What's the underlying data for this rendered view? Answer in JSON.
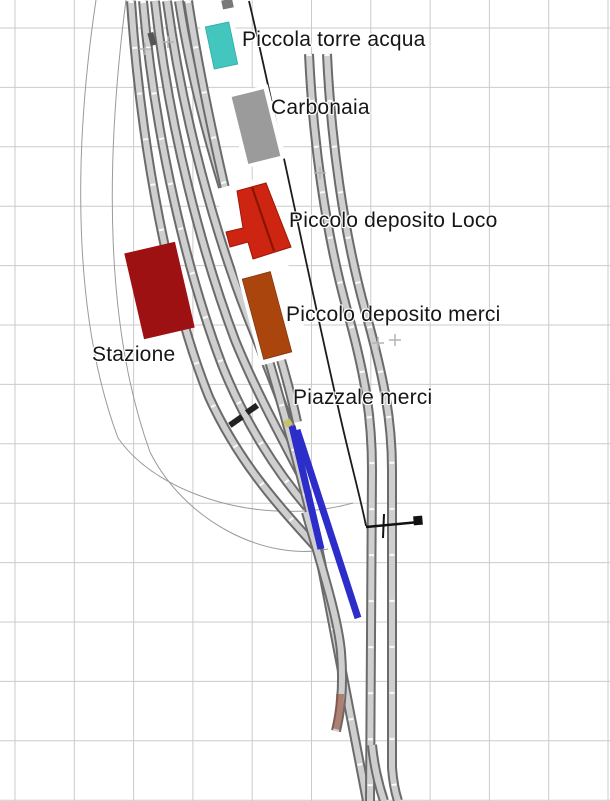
{
  "canvas": {
    "width": 610,
    "height": 801,
    "background": "#ffffff"
  },
  "labels": [
    {
      "id": "torre-acqua",
      "text": "Piccola torre acqua",
      "x": 242,
      "y": 29
    },
    {
      "id": "carbonaia",
      "text": "Carbonaia",
      "x": 271,
      "y": 97
    },
    {
      "id": "deposito-loco",
      "text": "Piccolo deposito Loco",
      "x": 289,
      "y": 210
    },
    {
      "id": "deposito-merci",
      "text": "Piccolo deposito merci",
      "x": 286,
      "y": 304
    },
    {
      "id": "stazione",
      "text": "Stazione",
      "x": 92,
      "y": 344
    },
    {
      "id": "piazzale-merci",
      "text": "Piazzale merci",
      "x": 293,
      "y": 387
    }
  ],
  "colors": {
    "grid": "#cbcbcb",
    "rail_edge": "#6b6b6b",
    "rail_fill": "#cfcfcf",
    "guide_curve": "#9a9a9a",
    "boundary_line": "#1c1c1c",
    "selection_blue": "#2d2dc9",
    "water_tower": "#43c6be",
    "coal_stage": "#9b9b9b",
    "loco_depot": "#ce2412",
    "goods_depot": "#ab450e",
    "station": "#9d1112",
    "marker_plus": "#b3b3b3"
  },
  "trackplan": {
    "grid": {
      "offset_x": 15,
      "offset_y": 28,
      "spacing_x": 59.3,
      "spacing_y": 59.4,
      "color": "#cbcbcb"
    },
    "items": [
      {
        "type": "path",
        "name": "guide-curve-left-outer",
        "click": false,
        "d": "M96,0 C72,160 74,320 118,438 C160,498 268,527 353,503",
        "color": "#9a9a9a",
        "w": 1
      },
      {
        "type": "path",
        "name": "guide-curve-left-inner",
        "click": false,
        "d": "M126,0 C104,170 106,330 150,452 C185,522 266,562 328,549",
        "color": "#9a9a9a",
        "w": 1
      },
      {
        "type": "track",
        "name": "yard-track-5",
        "click": true,
        "ties": false,
        "d": "M179,1 C196,110 230,215 258,290 C272,327 288,380 297,422"
      },
      {
        "type": "track",
        "name": "yard-track-4",
        "click": true,
        "ties": false,
        "d": "M167,1 C183,120 216,235 247,315 C263,355 284,407 299,452"
      },
      {
        "type": "track",
        "name": "yard-track-3",
        "click": true,
        "ties": false,
        "d": "M155,1 C169,130 203,255 235,340 C254,387 281,437 302,477"
      },
      {
        "type": "track",
        "name": "yard-track-2",
        "click": true,
        "ties": true,
        "d": "M143,1 C155,140 188,275 222,365 C245,423 277,472 307,507"
      },
      {
        "type": "track",
        "name": "yard-track-1",
        "click": true,
        "ties": true,
        "d": "M131,1 C141,150 170,300 209,397 C240,465 281,508 315,546"
      },
      {
        "type": "track",
        "name": "main-line",
        "click": true,
        "ties": true,
        "d": "M188,1 C208,130 248,290 276,385 C294,448 310,507 321,562 C331,617 348,705 367,801"
      },
      {
        "type": "track",
        "name": "stub-siding",
        "click": true,
        "ties": false,
        "d": "M306,512 C322,568 338,618 341,652 C344,690 340,714 336,731"
      },
      {
        "type": "track",
        "name": "right-line-1",
        "click": true,
        "ties": true,
        "d": "M309,54 C313,140 325,230 347,310 C366,378 372,420 372,470 L370,801"
      },
      {
        "type": "track",
        "name": "right-line-1-turnout",
        "click": true,
        "ties": false,
        "d": "M372,745 C374,766 379,786 384,801"
      },
      {
        "type": "track",
        "name": "right-line-2",
        "click": true,
        "ties": true,
        "d": "M327,54 C331,140 343,230 365,310 C384,378 392,420 392,470 L392,768 C393,781 395,792 398,801"
      },
      {
        "type": "path",
        "name": "stub-wear-tint",
        "click": false,
        "d": "M340,694 C340,710 338,721 336,729",
        "color": "rgba(150,75,55,0.6)",
        "w": 8
      },
      {
        "type": "path",
        "name": "boundary-line",
        "click": false,
        "d": "M249,1 C277,120 310,285 341,420 C352,468 361,500 366,526",
        "color": "#1c1c1c",
        "w": 1.8
      },
      {
        "type": "path",
        "name": "section-marker-bar",
        "click": false,
        "d": "M366,527 L419,522",
        "color": "#111111",
        "w": 2.5
      },
      {
        "type": "path",
        "name": "section-marker-tick",
        "click": false,
        "d": "M384,514 L383,538",
        "color": "#111111",
        "w": 2
      },
      {
        "type": "rect",
        "name": "section-marker-square",
        "click": false,
        "cx": 418,
        "cy": 520.5,
        "w": 9,
        "h": 9,
        "rot": -5,
        "fill": "#111111"
      },
      {
        "type": "plus",
        "name": "center-marker-1",
        "click": false,
        "x": 145,
        "y": 49,
        "r": 6,
        "color": "#b3b3b3"
      },
      {
        "type": "plus",
        "name": "center-marker-2",
        "click": false,
        "x": 168,
        "y": 42,
        "r": 6,
        "color": "#b3b3b3"
      },
      {
        "type": "plus",
        "name": "center-marker-3",
        "click": false,
        "x": 320,
        "y": 173,
        "r": 6,
        "color": "#b3b3b3"
      },
      {
        "type": "plus",
        "name": "center-marker-4",
        "click": false,
        "x": 378,
        "y": 343,
        "r": 6,
        "color": "#b3b3b3"
      },
      {
        "type": "plus",
        "name": "center-marker-5",
        "click": false,
        "x": 395,
        "y": 340,
        "r": 6,
        "color": "#b3b3b3"
      },
      {
        "type": "rect",
        "name": "buffer-stop-1",
        "click": false,
        "cx": 236,
        "cy": 421,
        "w": 15,
        "h": 6,
        "rot": -35,
        "fill": "#222222"
      },
      {
        "type": "rect",
        "name": "buffer-stop-2",
        "click": false,
        "cx": 252,
        "cy": 409,
        "w": 13,
        "h": 6,
        "rot": -35,
        "fill": "#222222"
      },
      {
        "type": "rect",
        "name": "yard-stub-block",
        "click": false,
        "cx": 152,
        "cy": 39,
        "w": 6,
        "h": 13,
        "rot": -15,
        "fill": "#555555"
      },
      {
        "type": "rect",
        "name": "top-edge-block",
        "click": false,
        "cx": 227.5,
        "cy": 4,
        "w": 11,
        "h": 9,
        "rot": -12,
        "fill": "#787878"
      },
      {
        "type": "rect",
        "name": "water-tower-pad",
        "click": false,
        "cx": 221.5,
        "cy": 45.5,
        "w": 34,
        "h": 52,
        "rot": -12,
        "fill": "#ffffff"
      },
      {
        "type": "rect",
        "name": "coal-stage-pad",
        "click": false,
        "cx": 256,
        "cy": 126.5,
        "w": 43,
        "h": 76,
        "rot": -14,
        "fill": "#ffffff"
      },
      {
        "type": "rect",
        "name": "depot-pad",
        "click": false,
        "cx": 263,
        "cy": 271,
        "w": 52,
        "h": 182,
        "rot": -14.5,
        "fill": "#ffffff"
      },
      {
        "type": "rect",
        "name": "water-tower-building",
        "click": true,
        "cx": 221.5,
        "cy": 45.5,
        "w": 24,
        "h": 43,
        "rot": -12,
        "fill": "#43c6be",
        "stroke": "#2fa9a2",
        "sw": 0.8
      },
      {
        "type": "rect",
        "name": "coal-stage-building",
        "click": true,
        "cx": 256,
        "cy": 126.5,
        "w": 33,
        "h": 69,
        "rot": -14,
        "fill": "#9b9b9b"
      },
      {
        "type": "polygon",
        "name": "loco-depot-building",
        "click": true,
        "points": [
          [
            237,
            191
          ],
          [
            266,
            183
          ],
          [
            291,
            247
          ],
          [
            253,
            259
          ],
          [
            248,
            242
          ],
          [
            230,
            247
          ],
          [
            226,
            232
          ],
          [
            243,
            228
          ]
        ],
        "fill": "#ce2412",
        "stroke": "#9e1705",
        "sw": 1
      },
      {
        "type": "path",
        "name": "loco-depot-ridge",
        "click": false,
        "d": "M252,187 L274,251",
        "color": "#8b1503",
        "w": 2.2
      },
      {
        "type": "rect",
        "name": "goods-depot-building",
        "click": true,
        "cx": 267,
        "cy": 315.5,
        "w": 29,
        "h": 83,
        "rot": -15,
        "fill": "#ab450e",
        "stroke": "#83350b",
        "sw": 0.8
      },
      {
        "type": "rect",
        "name": "station-building",
        "click": true,
        "cx": 159.5,
        "cy": 290.5,
        "w": 52,
        "h": 88,
        "rot": -13,
        "fill": "#9d1112"
      },
      {
        "type": "rect",
        "name": "signal-dot",
        "click": false,
        "cx": 288,
        "cy": 423,
        "w": 7,
        "h": 7,
        "rot": -30,
        "fill": "#c5c567"
      },
      {
        "type": "path",
        "name": "selected-track-segment-a",
        "click": true,
        "d": "M292,426 L321,549",
        "color": "#2d2dc9",
        "w": 7
      },
      {
        "type": "path",
        "name": "selected-track-segment-b",
        "click": true,
        "d": "M297,430 L358,618",
        "color": "#2d2dc9",
        "w": 7
      }
    ],
    "track_style": {
      "edge_color": "#6b6b6b",
      "edge_w": 10,
      "fill_color": "#cfcfcf",
      "fill_w": 6,
      "tie_color": "#ffffff",
      "tie_w": 5,
      "tie_dash": "2 44"
    }
  }
}
